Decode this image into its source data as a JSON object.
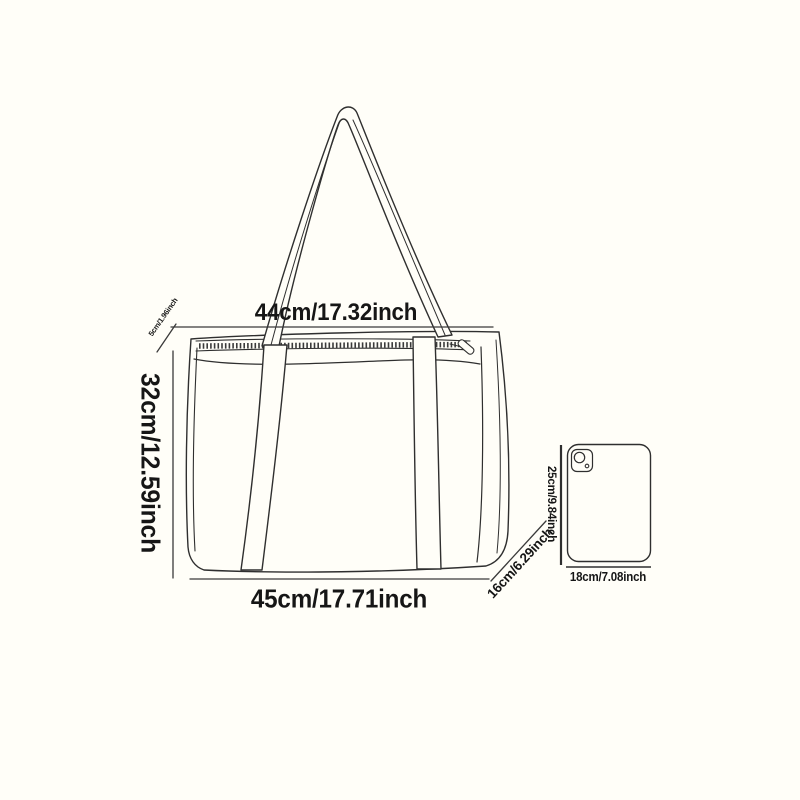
{
  "canvas": {
    "background": "#fffef8",
    "ink_color": "#2f2f2f",
    "text_color": "#161616"
  },
  "bag": {
    "top_width_label": "44cm/17.32inch",
    "height_label": "32cm/12.59inch",
    "bottom_width_label": "45cm/17.71inch",
    "depth_label": "16cm/6.29inch",
    "trim_label": "5cm/1.96inch"
  },
  "tablet": {
    "height_label": "25cm/9.84inch",
    "width_label": "18cm/7.08inch"
  }
}
